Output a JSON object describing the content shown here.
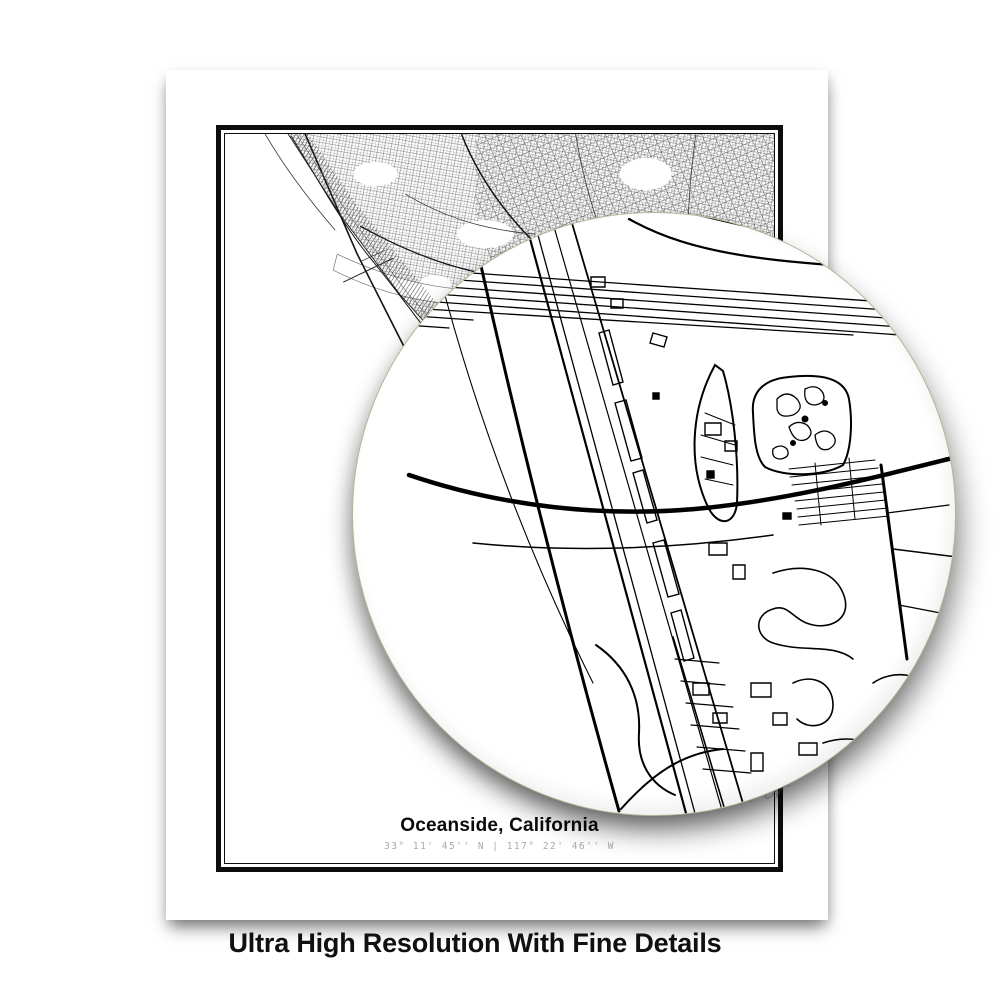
{
  "background_color": "#ffffff",
  "poster": {
    "title": "Oceanside, California",
    "coordinates": "33° 11' 45'' N | 117° 22' 46'' W",
    "paper_color": "#ffffff",
    "frame_color": "#0d0d0d",
    "map_ink_color": "#2a2a2a",
    "coords_text_color": "#a9a9a9"
  },
  "lens": {
    "kind": "magnifier-circle",
    "rim_color": "#b5b596",
    "map_ink_color": "#000000"
  },
  "caption": {
    "text": "Ultra High Resolution With Fine Details",
    "color": "#101010"
  }
}
